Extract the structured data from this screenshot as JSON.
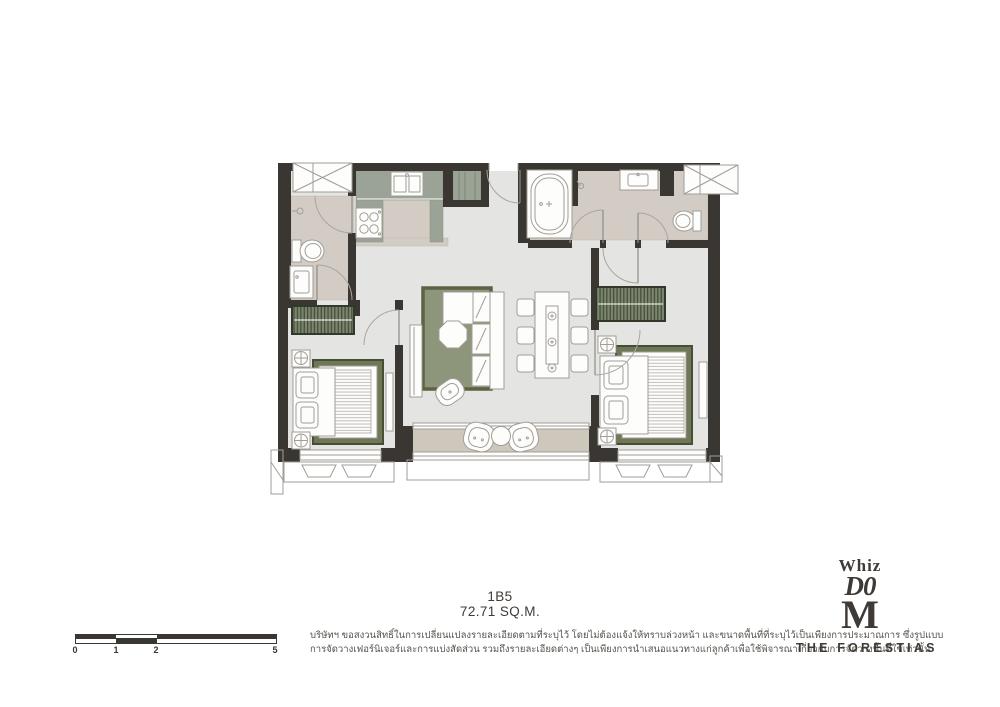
{
  "unit": {
    "model": "1B5",
    "area": "72.71 SQ.M."
  },
  "disclaimer": {
    "line1": "บริษัทฯ ขอสงวนสิทธิ์ในการเปลี่ยนแปลงรายละเอียดตามที่ระบุไว้ โดยไม่ต้องแจ้งให้ทราบล่วงหน้า และขนาดพื้นที่ที่ระบุไว้เป็นเพียงการประมาณการ ซึ่งรูปแบบ",
    "line2": "การจัดวางเฟอร์นิเจอร์และการแบ่งสัดส่วน รวมถึงรายละเอียดต่างๆ เป็นเพียงการนำเสนอแนวทางแก่ลูกค้าเพื่อใช้พิจารณาเกี่ยวกับการจัดวางพื้นที่ใช้เท่านั้น"
  },
  "scale_bar": {
    "labels": [
      "0",
      "1",
      "2",
      "5"
    ]
  },
  "logo": {
    "whiz": "Whiz",
    "dom": "D0",
    "m": "M",
    "brand": "THE FORESTIAS"
  },
  "colors": {
    "wall": "#3a3632",
    "floor": "#e4e5e2",
    "wet": "#d3ccc4",
    "balc": "#cec7bc",
    "cab": "#9aa396",
    "rug": "#8d957b",
    "rugborder": "#5a6342",
    "ink": "#3f3a36",
    "outline": "#a19d97",
    "text": "#56514b"
  }
}
